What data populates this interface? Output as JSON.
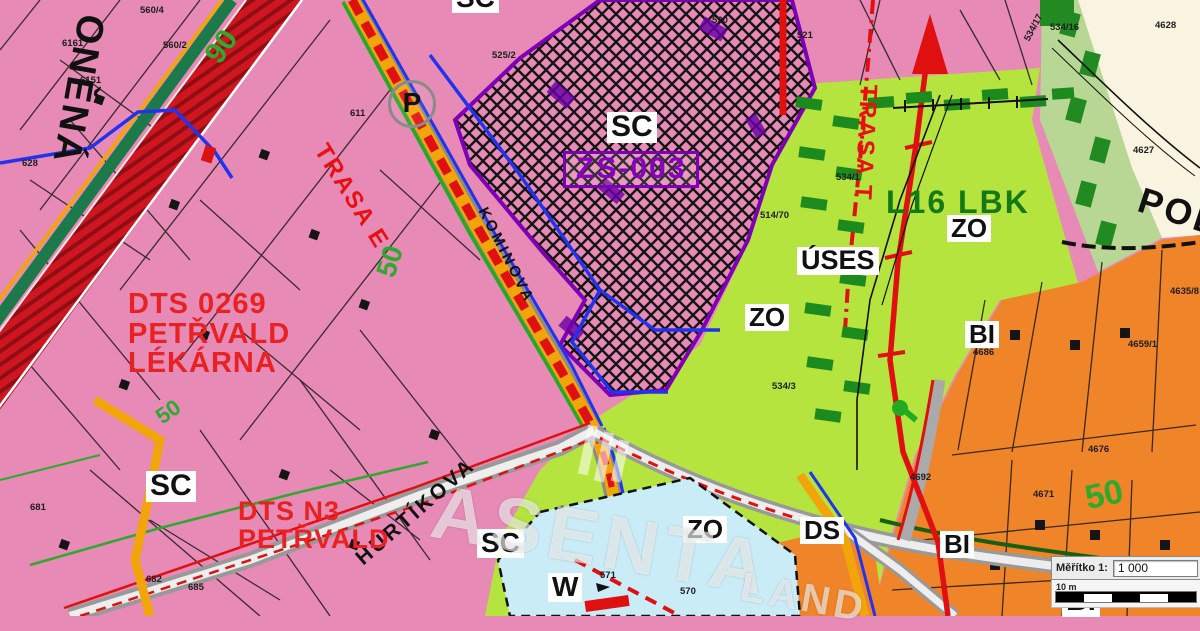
{
  "map_title": "Územní plán Petřvald — výřez",
  "colors": {
    "zone_sc_pink": "#e78ab5",
    "zone_zo_green": "#b5e43e",
    "zone_bi_orange": "#ef8428",
    "zone_pol_cream": "#f8f4e0",
    "zone_w_cyan": "#c9ecf7",
    "uses_dark_green": "#1c8a1c",
    "sage_strip": "#b8d694",
    "route_red": "#e01010",
    "zs_purple": "#7d00b4",
    "road_orange": "#f2a50a",
    "utility_blue": "#2233ee",
    "utility_green": "#22aa22"
  },
  "labels": [
    {
      "name": "zone-label-sc-top",
      "text": "SC",
      "x": 452,
      "y": -16,
      "cls": "zbox",
      "fs": 28
    },
    {
      "name": "zone-label-sc-hatched",
      "text": "SC",
      "x": 607,
      "y": 112,
      "cls": "zbox",
      "fs": 30
    },
    {
      "name": "zone-label-sc-left",
      "text": "SC",
      "x": 146,
      "y": 471,
      "cls": "zbox",
      "fs": 30
    },
    {
      "name": "zone-label-sc-bottom",
      "text": "SC",
      "x": 477,
      "y": 529,
      "cls": "zbox",
      "fs": 28
    },
    {
      "name": "zone-label-zs-003",
      "text": "ZS-003",
      "x": 563,
      "y": 151,
      "cls": "zs",
      "fs": 30
    },
    {
      "name": "zone-label-zo-center",
      "text": "ZO",
      "x": 745,
      "y": 304,
      "cls": "zbox",
      "fs": 26
    },
    {
      "name": "zone-label-zo-right",
      "text": "ZO",
      "x": 947,
      "y": 215,
      "cls": "zbox",
      "fs": 26
    },
    {
      "name": "zone-label-zo-bottom",
      "text": "ZO",
      "x": 683,
      "y": 516,
      "cls": "zbox",
      "fs": 26
    },
    {
      "name": "zone-label-uses",
      "text": "ÚSES",
      "x": 797,
      "y": 247,
      "cls": "zbox",
      "fs": 27
    },
    {
      "name": "zone-label-l16-lbk",
      "text": "L16 LBK",
      "x": 886,
      "y": 186,
      "cls": "gbig",
      "fs": 32
    },
    {
      "name": "zone-label-bi-right",
      "text": "BI",
      "x": 965,
      "y": 321,
      "cls": "zbox",
      "fs": 26
    },
    {
      "name": "zone-label-bi-bottom",
      "text": "BI",
      "x": 940,
      "y": 531,
      "cls": "zbox",
      "fs": 26
    },
    {
      "name": "zone-label-bi-corner",
      "text": "BI",
      "x": 1062,
      "y": 586,
      "cls": "zbox",
      "fs": 30
    },
    {
      "name": "zone-label-ds",
      "text": "DS",
      "x": 800,
      "y": 517,
      "cls": "zbox",
      "fs": 26
    },
    {
      "name": "zone-label-w",
      "text": "W",
      "x": 548,
      "y": 573,
      "cls": "zbox",
      "fs": 28
    },
    {
      "name": "street-label-pol",
      "text": "POL",
      "x": 1145,
      "y": 182,
      "cls": "street",
      "fs": 36,
      "rot": 18
    },
    {
      "name": "route-label-trasa-e",
      "text": "TRASA E",
      "x": 330,
      "y": 140,
      "cls": "trasa",
      "fs": 24,
      "rot": 58
    },
    {
      "name": "route-label-trasa-t",
      "text": "TRASA T",
      "x": 880,
      "y": 85,
      "cls": "trasa",
      "fs": 24,
      "rot": 93
    },
    {
      "name": "street-label-hurtikova",
      "text": "HURTÍKOVA",
      "x": 352,
      "y": 553,
      "cls": "street",
      "fs": 21,
      "rot": -41
    },
    {
      "name": "street-label-kominova",
      "text": "KOMINOVA",
      "x": 489,
      "y": 205,
      "cls": "street",
      "fs": 15,
      "rot": 63
    },
    {
      "name": "street-label-onena",
      "text": "ONĚNÁ",
      "x": 110,
      "y": 18,
      "cls": "street",
      "fs": 38,
      "rot": 100
    },
    {
      "name": "annotation-dts-lekarna",
      "text": "DTS 0269\nPETŘVALD\nLÉKÁRNA",
      "x": 128,
      "y": 290,
      "cls": "dts",
      "fs": 29
    },
    {
      "name": "annotation-dts-n3",
      "text": "DTS N3\nPETŘVALD",
      "x": 238,
      "y": 498,
      "cls": "dts",
      "fs": 27
    },
    {
      "name": "parking-symbol",
      "text": "P",
      "x": 388,
      "y": 80,
      "cls": "pcircle",
      "fs": 28
    },
    {
      "name": "road-number-90",
      "text": "90",
      "x": 200,
      "y": 52,
      "cls": "gnum",
      "fs": 30,
      "rot": -55
    },
    {
      "name": "road-number-50-a",
      "text": "50",
      "x": 372,
      "y": 272,
      "cls": "gnum",
      "fs": 28,
      "rot": -72
    },
    {
      "name": "road-number-50-b",
      "text": "50",
      "x": 1082,
      "y": 482,
      "cls": "gnum",
      "fs": 34,
      "rot": -12
    },
    {
      "name": "road-number-50-c",
      "text": "50",
      "x": 152,
      "y": 410,
      "cls": "gnum",
      "fs": 22,
      "rot": -35
    }
  ],
  "parcels": [
    {
      "text": "560/4",
      "x": 140,
      "y": 5
    },
    {
      "text": "560/2",
      "x": 163,
      "y": 40
    },
    {
      "text": "6161",
      "x": 62,
      "y": 38
    },
    {
      "text": "6151",
      "x": 80,
      "y": 75
    },
    {
      "text": "628",
      "x": 22,
      "y": 158
    },
    {
      "text": "611",
      "x": 350,
      "y": 108
    },
    {
      "text": "525/2",
      "x": 492,
      "y": 50
    },
    {
      "text": "520",
      "x": 712,
      "y": 15
    },
    {
      "text": "521",
      "x": 797,
      "y": 30
    },
    {
      "text": "534/17",
      "x": 1022,
      "y": 38,
      "rot": -62
    },
    {
      "text": "534/16",
      "x": 1050,
      "y": 22
    },
    {
      "text": "4628",
      "x": 1155,
      "y": 20
    },
    {
      "text": "4627",
      "x": 1133,
      "y": 145
    },
    {
      "text": "534/1",
      "x": 836,
      "y": 172
    },
    {
      "text": "514/70",
      "x": 760,
      "y": 210
    },
    {
      "text": "534/3",
      "x": 772,
      "y": 381
    },
    {
      "text": "4635/8",
      "x": 1170,
      "y": 286
    },
    {
      "text": "4659/1",
      "x": 1128,
      "y": 339
    },
    {
      "text": "4676",
      "x": 1088,
      "y": 444
    },
    {
      "text": "4671",
      "x": 1033,
      "y": 489
    },
    {
      "text": "4692",
      "x": 910,
      "y": 472
    },
    {
      "text": "4686",
      "x": 973,
      "y": 347
    },
    {
      "text": "4654",
      "x": 1170,
      "y": 566
    },
    {
      "text": "571",
      "x": 600,
      "y": 570
    },
    {
      "text": "570",
      "x": 680,
      "y": 586
    },
    {
      "text": "681",
      "x": 30,
      "y": 502
    },
    {
      "text": "685",
      "x": 188,
      "y": 582
    },
    {
      "text": "682",
      "x": 146,
      "y": 574
    }
  ],
  "watermark": {
    "text": "ASENTA",
    "text2": "LAND"
  },
  "scale_box": {
    "label": "Měřítko 1:",
    "value": "1 000",
    "bar_label": "10 m"
  }
}
